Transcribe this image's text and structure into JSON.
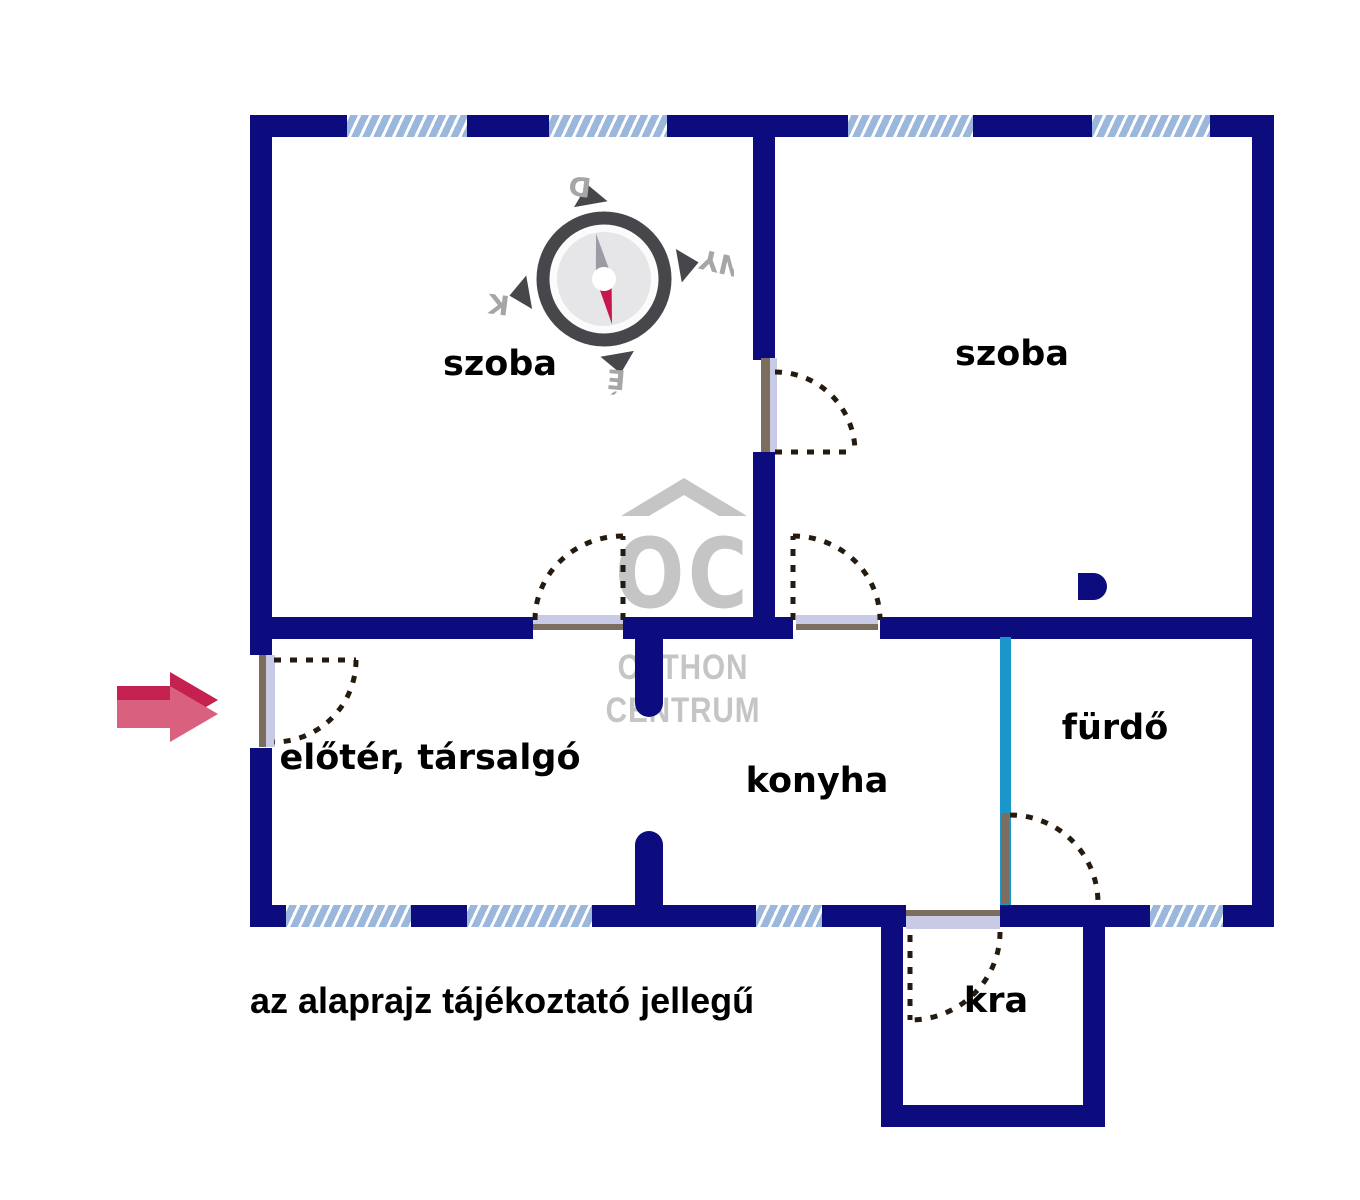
{
  "rooms": [
    {
      "id": "szoba-left",
      "label": "szoba"
    },
    {
      "id": "szoba-right",
      "label": "szoba"
    },
    {
      "id": "eloter",
      "label": "előtér, társalgó"
    },
    {
      "id": "konyha",
      "label": "konyha"
    },
    {
      "id": "furdo",
      "label": "fürdő"
    },
    {
      "id": "kamra",
      "label": "kra"
    }
  ],
  "disclaimer": "az alaprajz tájékoztató jellegű",
  "compass": {
    "top": "D",
    "right": "NY",
    "bottom": "É",
    "left": "K"
  },
  "watermark": {
    "monogram": "OC",
    "line1": "OTTHON",
    "line2": "CENTRUM"
  },
  "colors": {
    "wall": "#0c0c7e",
    "window": "#9bb7dc",
    "door_leaf": "#c9cbe6",
    "door_frame": "#7c6e5e",
    "dash": "#241a10",
    "light_partition": "#1a96ca",
    "watermark": "#c5c5c5",
    "compass_ring": "#47474b",
    "compass_disc": "#e6e6e8",
    "compass_needle_gray": "#9b9ba3",
    "compass_needle_red": "#c5174e",
    "compass_label": "#a6a6a6",
    "arrow_dark": "#c42050",
    "arrow_light": "#d9607e"
  }
}
